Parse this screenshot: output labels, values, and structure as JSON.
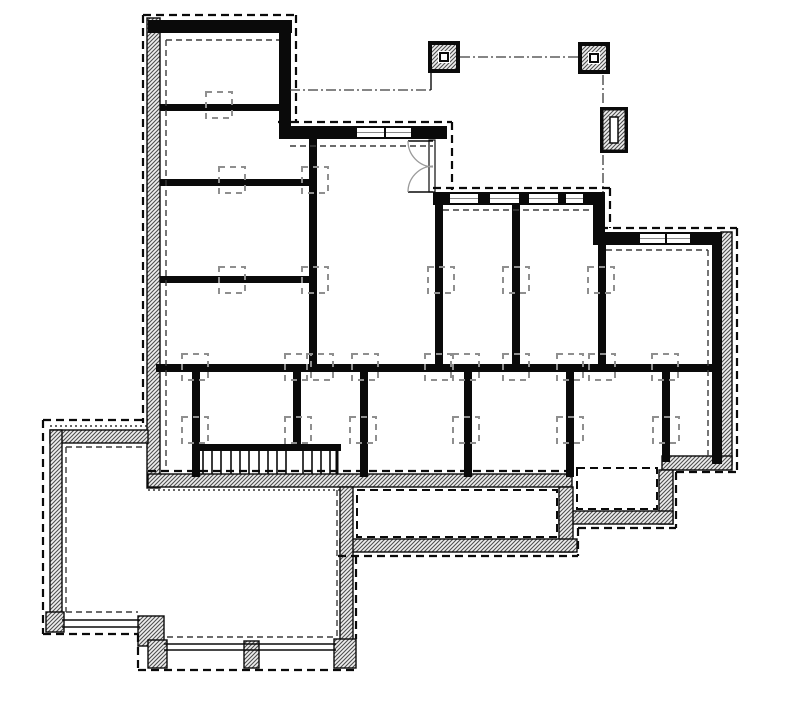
{
  "document": {
    "kind": "foundation-floor-plan",
    "canvas": {
      "width": 800,
      "height": 701,
      "background": "#ffffff"
    },
    "colors": {
      "ink": "#0a0a0a",
      "hatch_line": "#4e4e4e",
      "hatch_bg": "#efefef",
      "pier_dash": "#8f8f8f",
      "inner_dash": "#3c3c3c",
      "door_arc": "#9a9a9a",
      "glaze": "#8a8a8a"
    }
  },
  "hatch_bands": [
    {
      "name": "left-foundation-wall",
      "x": 147,
      "y": 18,
      "w": 13,
      "h": 470
    },
    {
      "name": "right-foundation-wall",
      "x": 721,
      "y": 232,
      "w": 11,
      "h": 232
    },
    {
      "name": "bottom-foundation-wall",
      "x": 148,
      "y": 474,
      "w": 424,
      "h": 13
    },
    {
      "name": "se-bottom-foundation-wall",
      "x": 662,
      "y": 456,
      "w": 70,
      "h": 14
    },
    {
      "name": "bumpout-right-wall",
      "x": 659,
      "y": 470,
      "w": 14,
      "h": 54
    },
    {
      "name": "bumpout-bottom-wall",
      "x": 559,
      "y": 511,
      "w": 114,
      "h": 13
    },
    {
      "name": "porch-right-wall",
      "x": 559,
      "y": 487,
      "w": 14,
      "h": 65
    },
    {
      "name": "porch-bottom-wall",
      "x": 340,
      "y": 539,
      "w": 237,
      "h": 13
    },
    {
      "name": "porch-left-patio-band",
      "x": 340,
      "y": 487,
      "w": 13,
      "h": 153
    },
    {
      "name": "patio-top-band",
      "x": 50,
      "y": 430,
      "w": 98,
      "h": 13
    },
    {
      "name": "patio-left-band",
      "x": 50,
      "y": 430,
      "w": 12,
      "h": 190
    },
    {
      "name": "patio-corner-block-sw",
      "x": 46,
      "y": 612,
      "w": 18,
      "h": 20
    },
    {
      "name": "patio-step-block-a",
      "x": 138,
      "y": 616,
      "w": 26,
      "h": 30
    },
    {
      "name": "patio-step-block-b",
      "x": 148,
      "y": 640,
      "w": 19,
      "h": 28
    },
    {
      "name": "patio-pilaster",
      "x": 244,
      "y": 641,
      "w": 15,
      "h": 27
    },
    {
      "name": "patio-corner-block-se",
      "x": 334,
      "y": 639,
      "w": 22,
      "h": 29
    }
  ],
  "black_walls": [
    {
      "name": "top-wall-upper-left",
      "x": 148,
      "y": 20,
      "w": 144,
      "h": 13
    },
    {
      "name": "upper-left-right-wall",
      "x": 279,
      "y": 20,
      "w": 12,
      "h": 118
    },
    {
      "name": "upper-step-wall",
      "x": 279,
      "y": 126,
      "w": 168,
      "h": 13
    },
    {
      "name": "mid-top-wall",
      "x": 433,
      "y": 192,
      "w": 172,
      "h": 13
    },
    {
      "name": "step-wall-right",
      "x": 593,
      "y": 192,
      "w": 12,
      "h": 53
    },
    {
      "name": "right-top-wall",
      "x": 593,
      "y": 232,
      "w": 129,
      "h": 13
    },
    {
      "name": "right-wall-core",
      "x": 712,
      "y": 232,
      "w": 10,
      "h": 232
    },
    {
      "name": "int-wall-a",
      "x": 160,
      "y": 104,
      "w": 125,
      "h": 7
    },
    {
      "name": "int-wall-b",
      "x": 160,
      "y": 179,
      "w": 156,
      "h": 7
    },
    {
      "name": "int-wall-c",
      "x": 160,
      "y": 276,
      "w": 156,
      "h": 7
    },
    {
      "name": "int-wall-v1",
      "x": 309,
      "y": 133,
      "w": 8,
      "h": 235
    },
    {
      "name": "int-wall-v2",
      "x": 435,
      "y": 202,
      "w": 8,
      "h": 166
    },
    {
      "name": "int-wall-v3",
      "x": 512,
      "y": 202,
      "w": 8,
      "h": 166
    },
    {
      "name": "int-wall-v4",
      "x": 598,
      "y": 243,
      "w": 8,
      "h": 125
    },
    {
      "name": "main-beam",
      "x": 156,
      "y": 364,
      "w": 566,
      "h": 8
    },
    {
      "name": "post-wall-1",
      "x": 192,
      "y": 370,
      "w": 8,
      "h": 107
    },
    {
      "name": "post-wall-2",
      "x": 293,
      "y": 370,
      "w": 8,
      "h": 80
    },
    {
      "name": "post-wall-3",
      "x": 360,
      "y": 370,
      "w": 8,
      "h": 107
    },
    {
      "name": "post-wall-4",
      "x": 464,
      "y": 370,
      "w": 8,
      "h": 107
    },
    {
      "name": "post-wall-5",
      "x": 566,
      "y": 370,
      "w": 8,
      "h": 107
    },
    {
      "name": "post-wall-6",
      "x": 662,
      "y": 370,
      "w": 8,
      "h": 92
    },
    {
      "name": "stair-rail",
      "x": 197,
      "y": 444,
      "w": 144,
      "h": 7
    }
  ],
  "windows": [
    {
      "name": "window-upper-1",
      "x": 357,
      "y": 128,
      "w": 27,
      "h": 9
    },
    {
      "name": "window-upper-2",
      "x": 386,
      "y": 128,
      "w": 25,
      "h": 9
    },
    {
      "name": "window-mid-1",
      "x": 450,
      "y": 194,
      "w": 28,
      "h": 9
    },
    {
      "name": "window-mid-2",
      "x": 490,
      "y": 194,
      "w": 29,
      "h": 9
    },
    {
      "name": "window-mid-3",
      "x": 529,
      "y": 194,
      "w": 29,
      "h": 9
    },
    {
      "name": "window-mid-4",
      "x": 566,
      "y": 194,
      "w": 17,
      "h": 9
    },
    {
      "name": "window-right-1",
      "x": 640,
      "y": 234,
      "w": 25,
      "h": 9
    },
    {
      "name": "window-right-2",
      "x": 667,
      "y": 234,
      "w": 23,
      "h": 9
    }
  ],
  "door": {
    "panel": {
      "x": 429,
      "y": 140,
      "w": 6,
      "h": 52
    },
    "leaves": [
      {
        "x1": 408,
        "y1": 141,
        "x2": 433,
        "y2": 141
      },
      {
        "x1": 408,
        "y1": 192,
        "x2": 433,
        "y2": 192
      }
    ],
    "arcs": [
      "M408,141 A26,26 0 0 0 433,167",
      "M408,192 A26,26 0 0 1 433,166"
    ]
  },
  "stairs": {
    "y1": 451,
    "y2": 474,
    "treads": [
      203,
      212,
      221,
      231,
      240,
      249,
      259,
      268,
      277,
      286,
      303,
      312,
      321,
      330
    ],
    "end_line": {
      "x": 337,
      "y1": 447,
      "y2": 474
    }
  },
  "pier_boxes": {
    "size": 26,
    "centers": [
      [
        219,
        105
      ],
      [
        232,
        180
      ],
      [
        315,
        180
      ],
      [
        232,
        280
      ],
      [
        315,
        280
      ],
      [
        441,
        280
      ],
      [
        516,
        280
      ],
      [
        601,
        280
      ],
      [
        195,
        367
      ],
      [
        298,
        367
      ],
      [
        320,
        367
      ],
      [
        365,
        367
      ],
      [
        438,
        367
      ],
      [
        466,
        367
      ],
      [
        516,
        367
      ],
      [
        570,
        367
      ],
      [
        602,
        367
      ],
      [
        665,
        367
      ],
      [
        195,
        430
      ],
      [
        298,
        430
      ],
      [
        363,
        430
      ],
      [
        466,
        430
      ],
      [
        570,
        430
      ],
      [
        666,
        430
      ]
    ]
  },
  "deck_posts": [
    {
      "name": "deck-post-1",
      "x": 428,
      "y": 41,
      "size": 32
    },
    {
      "name": "deck-post-2",
      "x": 578,
      "y": 42,
      "size": 32
    }
  ],
  "pier_pad": {
    "x": 600,
    "y": 107,
    "w": 28,
    "h": 46,
    "slot": {
      "x": 610,
      "y": 117,
      "w": 8,
      "h": 26
    }
  },
  "dashdot_lines": [
    {
      "name": "centerline-posts",
      "x1": 460,
      "y1": 57,
      "x2": 578,
      "y2": 57
    },
    {
      "name": "centerline-upper",
      "x1": 290,
      "y1": 90,
      "x2": 431,
      "y2": 90
    },
    {
      "name": "centerline-right-a",
      "x1": 603,
      "y1": 75,
      "x2": 603,
      "y2": 105
    },
    {
      "name": "centerline-right-b",
      "x1": 603,
      "y1": 155,
      "x2": 603,
      "y2": 192
    }
  ],
  "thin_lines": [
    {
      "name": "centerline-elbow",
      "x1": 431,
      "y1": 73,
      "x2": 431,
      "y2": 90
    },
    {
      "name": "sill-upper-1",
      "x1": 62,
      "y1": 620,
      "x2": 140,
      "y2": 620
    },
    {
      "name": "sill-upper-2",
      "x1": 62,
      "y1": 627,
      "x2": 140,
      "y2": 627
    },
    {
      "name": "sill-lower-1",
      "x1": 164,
      "y1": 644,
      "x2": 336,
      "y2": 644
    },
    {
      "name": "sill-lower-2",
      "x1": 164,
      "y1": 650,
      "x2": 336,
      "y2": 650
    }
  ],
  "outer_dashed": [
    {
      "x1": 143,
      "y1": 15,
      "x2": 296,
      "y2": 15
    },
    {
      "x1": 143,
      "y1": 15,
      "x2": 143,
      "y2": 423
    },
    {
      "x1": 296,
      "y1": 15,
      "x2": 296,
      "y2": 122
    },
    {
      "x1": 278,
      "y1": 122,
      "x2": 452,
      "y2": 122
    },
    {
      "x1": 452,
      "y1": 122,
      "x2": 452,
      "y2": 190
    },
    {
      "x1": 433,
      "y1": 188,
      "x2": 610,
      "y2": 188
    },
    {
      "x1": 610,
      "y1": 188,
      "x2": 610,
      "y2": 228
    },
    {
      "x1": 600,
      "y1": 228,
      "x2": 737,
      "y2": 228
    },
    {
      "x1": 737,
      "y1": 228,
      "x2": 737,
      "y2": 472
    },
    {
      "x1": 676,
      "y1": 472,
      "x2": 737,
      "y2": 472
    },
    {
      "x1": 676,
      "y1": 472,
      "x2": 676,
      "y2": 528
    },
    {
      "x1": 578,
      "y1": 528,
      "x2": 676,
      "y2": 528
    },
    {
      "x1": 578,
      "y1": 528,
      "x2": 578,
      "y2": 556
    },
    {
      "x1": 338,
      "y1": 556,
      "x2": 578,
      "y2": 556
    },
    {
      "x1": 356,
      "y1": 556,
      "x2": 356,
      "y2": 639
    },
    {
      "x1": 148,
      "y1": 471,
      "x2": 571,
      "y2": 471
    },
    {
      "x1": 43,
      "y1": 420,
      "x2": 148,
      "y2": 420
    },
    {
      "x1": 43,
      "y1": 420,
      "x2": 43,
      "y2": 634
    },
    {
      "x1": 43,
      "y1": 634,
      "x2": 138,
      "y2": 634
    },
    {
      "x1": 138,
      "y1": 634,
      "x2": 138,
      "y2": 670
    },
    {
      "x1": 138,
      "y1": 670,
      "x2": 356,
      "y2": 670
    }
  ],
  "inner_dashed": [
    {
      "x1": 166,
      "y1": 40,
      "x2": 279,
      "y2": 40
    },
    {
      "x1": 166,
      "y1": 40,
      "x2": 166,
      "y2": 470
    },
    {
      "x1": 290,
      "y1": 146,
      "x2": 433,
      "y2": 146
    },
    {
      "x1": 443,
      "y1": 210,
      "x2": 593,
      "y2": 210
    },
    {
      "x1": 606,
      "y1": 250,
      "x2": 708,
      "y2": 250
    },
    {
      "x1": 708,
      "y1": 250,
      "x2": 708,
      "y2": 456
    },
    {
      "x1": 66,
      "y1": 447,
      "x2": 148,
      "y2": 447
    },
    {
      "x1": 66,
      "y1": 447,
      "x2": 66,
      "y2": 612
    },
    {
      "x1": 66,
      "y1": 612,
      "x2": 138,
      "y2": 612
    },
    {
      "x1": 167,
      "y1": 637,
      "x2": 334,
      "y2": 637
    },
    {
      "x1": 337,
      "y1": 490,
      "x2": 337,
      "y2": 636
    }
  ],
  "inner_dashed_rects": [
    {
      "name": "porch-inner-outline",
      "x": 357,
      "y": 490,
      "w": 200,
      "h": 47
    },
    {
      "name": "bumpout-inner-outline",
      "x": 577,
      "y": 468,
      "w": 80,
      "h": 41
    }
  ],
  "dotted_lines": [
    {
      "x1": 148,
      "y1": 490,
      "x2": 343,
      "y2": 490
    },
    {
      "x1": 50,
      "y1": 426,
      "x2": 148,
      "y2": 426
    }
  ]
}
